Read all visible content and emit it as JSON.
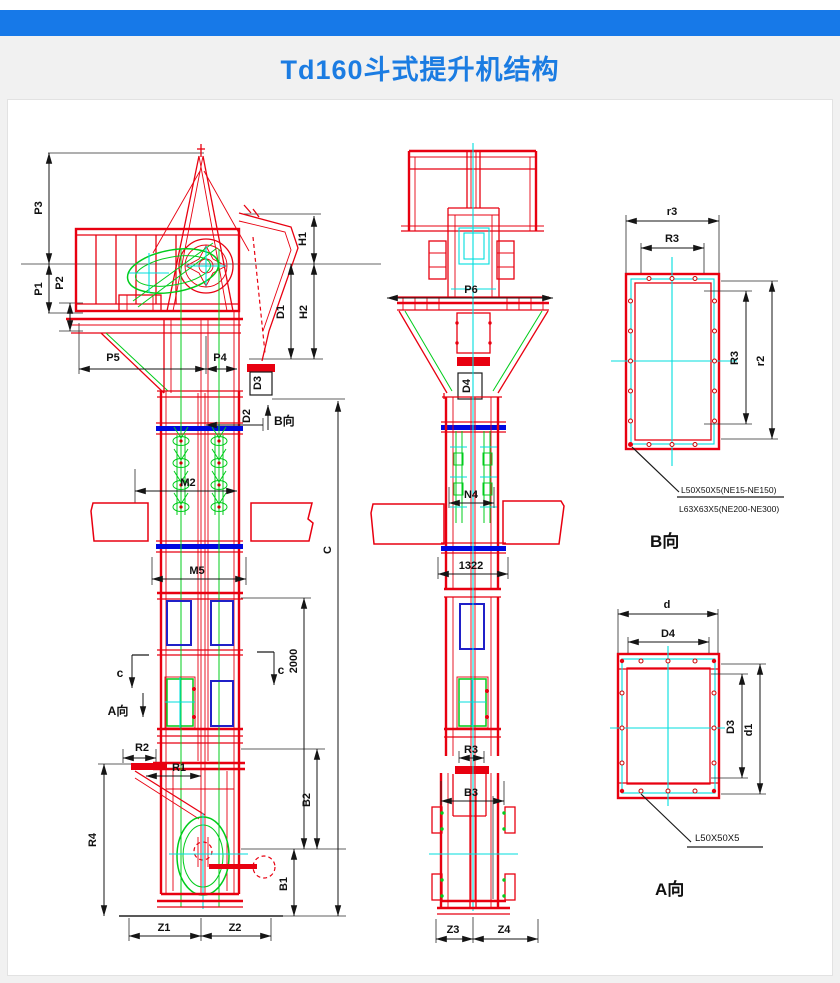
{
  "title": "Td160斗式提升机结构",
  "colors": {
    "accent_blue": "#1779e8",
    "title_blue": "#1b7ce2",
    "drawing_red": "#e80010",
    "drawing_green": "#00cc1b",
    "drawing_cyan": "#00dede",
    "drawing_blue": "#0008e0"
  },
  "front": {
    "p3": "P3",
    "p1": "P1",
    "p2": "P2",
    "p5": "P5",
    "p4": "P4",
    "h1": "H1",
    "d1": "D1",
    "h2": "H2",
    "d3": "D3",
    "d2": "D2",
    "b_view_arrow": "B向",
    "m2": "M2",
    "m5": "M5",
    "total_height": "C",
    "mid_height": "2000",
    "section_c_left": "c",
    "section_c_right": "c",
    "a_view_arrow": "A向",
    "r2": "R2",
    "r1": "R1",
    "r4": "R4",
    "b2": "B2",
    "b1": "B1",
    "z1": "Z1",
    "z2": "Z2"
  },
  "side": {
    "p6": "P6",
    "d4": "D4",
    "n4": "N4",
    "span_1322": "1322",
    "r3": "R3",
    "b3": "B3",
    "z3": "Z3",
    "z4": "Z4"
  },
  "detail_b": {
    "caption": "B向",
    "r3_top_outer": "r3",
    "r3_top_inner": "R3",
    "r3_right_inner": "R3",
    "r2_right_outer": "r2",
    "notes": [
      "L50X50X5(NE15-NE150)",
      "L63X63X5(NE200-NE300)"
    ]
  },
  "detail_a": {
    "caption": "A向",
    "d_outer": "d",
    "d4_inner": "D4",
    "d3_right_inner": "D3",
    "d1_right_outer": "d1",
    "note": "L50X50X5"
  }
}
